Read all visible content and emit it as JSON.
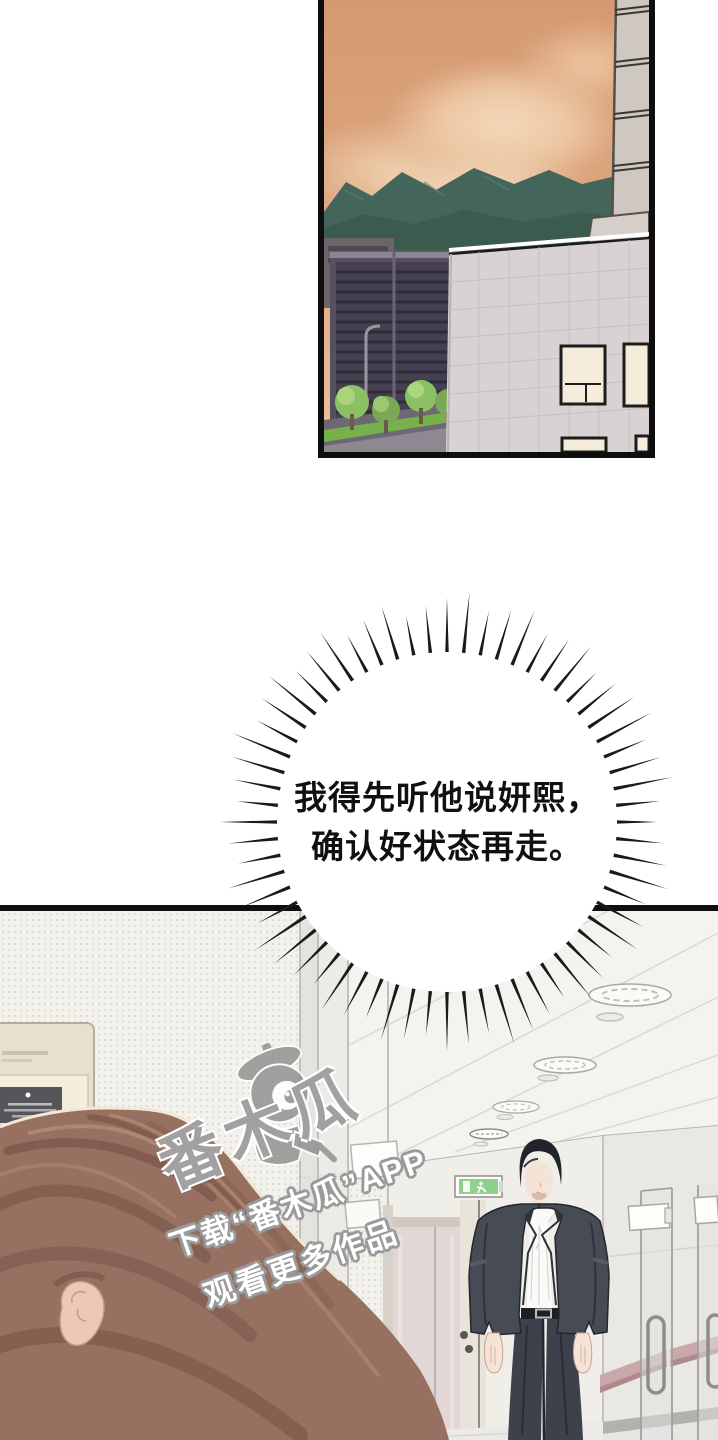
{
  "bubble": {
    "line1": "我得先听他说妍熙，",
    "line2": "确认好状态再走。"
  },
  "watermark": {
    "brand": "番木瓜",
    "line1": "下载“番木瓜”APP",
    "line2": "观看更多作品"
  },
  "scenes": [
    {
      "label": "sunset-cityscape"
    },
    {
      "label": "hospital-corridor"
    }
  ],
  "colors": {
    "sky": "#d9a078",
    "mountains": "#44655a",
    "dark_building": "#56505e",
    "light_building": "#d8d3d2",
    "exit_green": "#8fd08d",
    "suit": "#464b54",
    "shirt": "#fbfaf8",
    "skin": "#f5e3d7",
    "hair_brown": "#967060",
    "hair_shadow": "#7b574a",
    "handrail_pink": "#c9a8ab",
    "elevator_pink": "#e2d6d6",
    "watermark_gray": "#8e8e8e"
  }
}
